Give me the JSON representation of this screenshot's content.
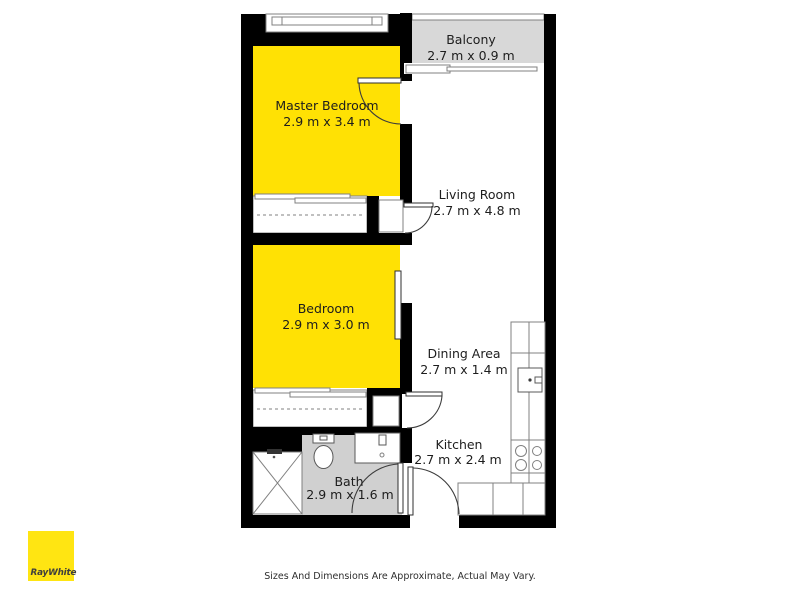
{
  "page": {
    "background": "#ffffff"
  },
  "brand": {
    "name": "RayWhite"
  },
  "footer": {
    "disclaimer": "Sizes And Dimensions Are Approximate, Actual May Vary."
  },
  "palette": {
    "wall": "#000000",
    "room_highlight": "#FFE104",
    "balcony_fill": "#D8D8D8",
    "bath_fill": "#D0D0D0",
    "logo_bg": "#FFE512",
    "label_color": "#1d1d1d"
  },
  "floorplan": {
    "rooms": [
      {
        "name": "Master Bedroom",
        "dimensions": "2.9 m x 3.4 m",
        "highlighted": true
      },
      {
        "name": "Balcony",
        "dimensions": "2.7 m x 0.9 m",
        "highlighted": false
      },
      {
        "name": "Living Room",
        "dimensions": "2.7 m x 4.8 m",
        "highlighted": false
      },
      {
        "name": "Bedroom",
        "dimensions": "2.9 m x 3.0 m",
        "highlighted": true
      },
      {
        "name": "Dining Area",
        "dimensions": "2.7 m x 1.4 m",
        "highlighted": false
      },
      {
        "name": "Kitchen",
        "dimensions": "2.7 m x 2.4 m",
        "highlighted": false
      },
      {
        "name": "Bath",
        "dimensions": "2.9 m x 1.6 m",
        "highlighted": false
      }
    ],
    "fixtures": [
      "shower",
      "toilet",
      "vanity-sink",
      "kitchen-sink",
      "cooktop",
      "fridge-space",
      "wardrobe-master",
      "wardrobe-bedroom",
      "linen-cupboard-upper",
      "linen-cupboard-lower",
      "balcony-sliding-door",
      "bedroom-sliding-door",
      "entry-door",
      "window"
    ]
  }
}
